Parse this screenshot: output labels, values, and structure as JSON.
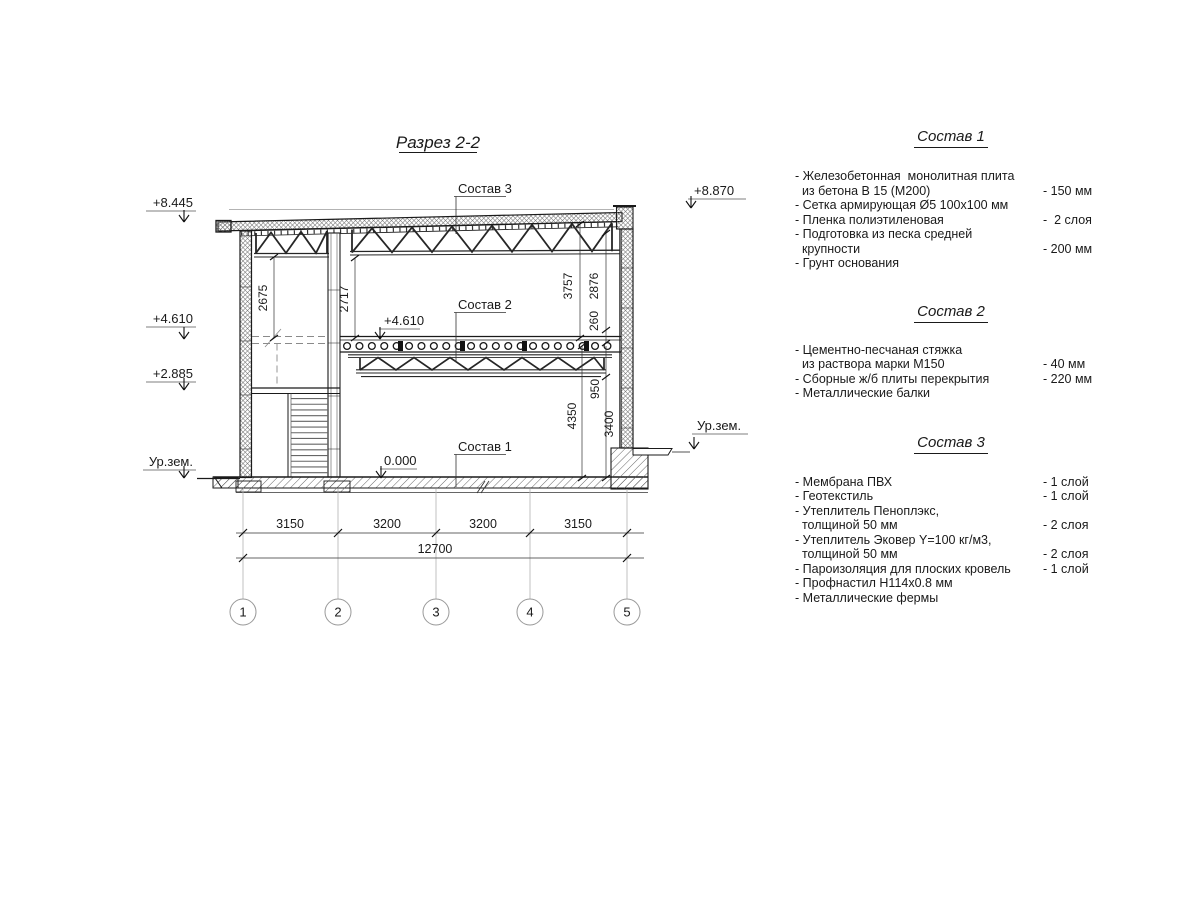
{
  "title": "Разрез 2-2",
  "section_labels": {
    "sostav1": "Состав 1",
    "sostav2": "Состав 2",
    "sostav3": "Состав 3"
  },
  "elevations": {
    "left_top": "+8.445",
    "left_mid": "+4.610",
    "left_low": "+2.885",
    "ground_left": "Ур.зем.",
    "right_top": "+8.870",
    "ground_right": "Ур.зем.",
    "interior_level": "+4.610",
    "zero_level": "0.000"
  },
  "dims": {
    "v1": "2675",
    "v2": "2717",
    "v3": "3757",
    "v4": "2876",
    "v5": "260",
    "v6": "950",
    "v7": "4350",
    "v8": "3400",
    "h1": "3150",
    "h2": "3200",
    "h3": "3200",
    "h4": "3150",
    "total": "12700"
  },
  "axes": [
    "1",
    "2",
    "3",
    "4",
    "5"
  ],
  "specs": [
    {
      "title": "Состав 1",
      "lines": [
        {
          "text": "- Железобетонная  монолитная плита",
          "value": ""
        },
        {
          "text": "  из бетона В 15 (М200)",
          "value": "- 150 мм"
        },
        {
          "text": "- Сетка армирующая Ø5 100х100 мм",
          "value": ""
        },
        {
          "text": "- Пленка полиэтиленовая",
          "value": "-  2 слоя"
        },
        {
          "text": "- Подготовка из песка средней",
          "value": ""
        },
        {
          "text": "  крупности",
          "value": "- 200 мм"
        },
        {
          "text": "- Грунт основания",
          "value": ""
        }
      ]
    },
    {
      "title": "Состав 2",
      "lines": [
        {
          "text": "- Цементно-песчаная стяжка",
          "value": ""
        },
        {
          "text": "  из раствора марки М150",
          "value": "- 40 мм"
        },
        {
          "text": "- Сборные ж/б плиты перекрытия",
          "value": "- 220 мм"
        },
        {
          "text": "- Металлические балки",
          "value": ""
        }
      ]
    },
    {
      "title": "Состав 3",
      "lines": [
        {
          "text": "- Мембрана ПВХ",
          "value": "- 1 слой"
        },
        {
          "text": "- Геотекстиль",
          "value": "- 1 слой"
        },
        {
          "text": "- Утеплитель Пеноплэкс,",
          "value": ""
        },
        {
          "text": "  толщиной 50 мм",
          "value": "- 2 слоя"
        },
        {
          "text": "- Утеплитель Эковер Y=100 кг/м3,",
          "value": ""
        },
        {
          "text": "  толщиной 50 мм",
          "value": "- 2 слоя"
        },
        {
          "text": "- Пароизоляция для плоских кровель",
          "value": "- 1 слой"
        },
        {
          "text": "- Профнастил Н114х0.8 мм",
          "value": ""
        },
        {
          "text": "- Металлические фермы",
          "value": ""
        }
      ]
    }
  ]
}
